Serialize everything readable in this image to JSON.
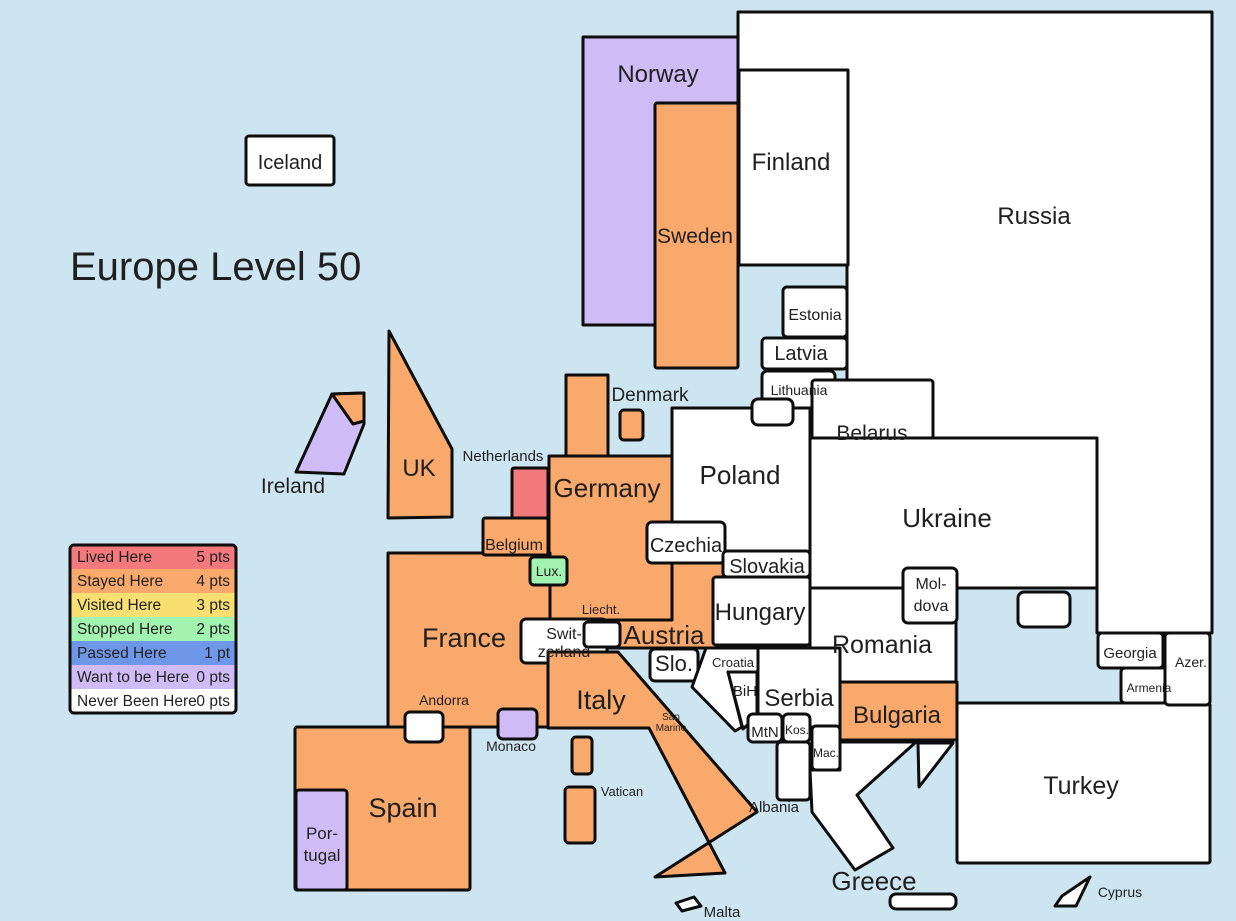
{
  "title": "Europe Level 50",
  "palette": {
    "sea": "#cde5f1",
    "outline": "#0d0d0d",
    "lived": "#f4797d",
    "stayed": "#f9a96b",
    "visited": "#f9df72",
    "stopped": "#a2f2b0",
    "passed": "#6e97e9",
    "want": "#cfbcf7",
    "never": "#ffffff"
  },
  "legend": {
    "rows": [
      {
        "label": "Lived Here",
        "points": "5 pts",
        "color": "#f4797d"
      },
      {
        "label": "Stayed Here",
        "points": "4 pts",
        "color": "#f9a96b"
      },
      {
        "label": "Visited Here",
        "points": "3 pts",
        "color": "#f9df72"
      },
      {
        "label": "Stopped Here",
        "points": "2 pts",
        "color": "#a2f2b0"
      },
      {
        "label": "Passed Here",
        "points": "1 pt",
        "color": "#6e97e9"
      },
      {
        "label": "Want to be Here",
        "points": "0 pts",
        "color": "#cfbcf7"
      },
      {
        "label": "Never Been Here",
        "points": "0 pts",
        "color": "#ffffff"
      }
    ]
  },
  "countries": {
    "iceland": {
      "label": "Iceland",
      "status": "never"
    },
    "norway": {
      "label": "Norway",
      "status": "want"
    },
    "sweden": {
      "label": "Sweden",
      "status": "stayed"
    },
    "finland": {
      "label": "Finland",
      "status": "never"
    },
    "russia": {
      "label": "Russia",
      "status": "never"
    },
    "estonia": {
      "label": "Estonia",
      "status": "never"
    },
    "latvia": {
      "label": "Latvia",
      "status": "never"
    },
    "lithuania": {
      "label": "Lithuania",
      "status": "never"
    },
    "denmark": {
      "label": "Denmark",
      "status": "stayed"
    },
    "uk": {
      "label": "UK",
      "status": "stayed"
    },
    "ireland": {
      "label": "Ireland",
      "status": "want"
    },
    "netherlands": {
      "label": "Netherlands",
      "status": "lived"
    },
    "belgium": {
      "label": "Belgium",
      "status": "stayed"
    },
    "luxembourg": {
      "label": "Lux.",
      "status": "stopped"
    },
    "germany": {
      "label": "Germany",
      "status": "stayed"
    },
    "poland": {
      "label": "Poland",
      "status": "never"
    },
    "belarus": {
      "label": "Belarus",
      "status": "never"
    },
    "ukraine": {
      "label": "Ukraine",
      "status": "never"
    },
    "czechia": {
      "label": "Czechia",
      "status": "never"
    },
    "slovakia": {
      "label": "Slovakia",
      "status": "never"
    },
    "hungary": {
      "label": "Hungary",
      "status": "never"
    },
    "austria": {
      "label": "Austria",
      "status": "stayed"
    },
    "switzerland": {
      "line1": "Swit-",
      "line2": "zerland",
      "status": "never"
    },
    "liechtenstein": {
      "label": "Liecht.",
      "status": "never"
    },
    "france": {
      "label": "France",
      "status": "stayed"
    },
    "andorra": {
      "label": "Andorra",
      "status": "never"
    },
    "monaco": {
      "label": "Monaco",
      "status": "want"
    },
    "spain": {
      "label": "Spain",
      "status": "stayed"
    },
    "portugal": {
      "line1": "Por-",
      "line2": "tugal",
      "status": "want"
    },
    "italy": {
      "label": "Italy",
      "status": "stayed"
    },
    "san_marino": {
      "line1": "San",
      "line2": "Marino",
      "status": "never"
    },
    "vatican": {
      "label": "Vatican",
      "status": "visited"
    },
    "slovenia": {
      "label": "Slo.",
      "status": "never"
    },
    "croatia": {
      "label": "Croatia",
      "status": "never"
    },
    "bih": {
      "label": "BiH",
      "status": "never"
    },
    "serbia": {
      "label": "Serbia",
      "status": "never"
    },
    "montenegro": {
      "label": "MtN",
      "status": "never"
    },
    "kosovo": {
      "label": "Kos.",
      "status": "never"
    },
    "macedonia": {
      "label": "Mac.",
      "status": "never"
    },
    "albania": {
      "label": "Albania",
      "status": "never"
    },
    "romania": {
      "label": "Romania",
      "status": "never"
    },
    "moldova": {
      "line1": "Mol-",
      "line2": "dova",
      "status": "never"
    },
    "bulgaria": {
      "label": "Bulgaria",
      "status": "stayed"
    },
    "greece": {
      "label": "Greece",
      "status": "never"
    },
    "turkey": {
      "label": "Turkey",
      "status": "never"
    },
    "georgia": {
      "label": "Georgia",
      "status": "never"
    },
    "armenia": {
      "label": "Armenia",
      "status": "never"
    },
    "azerbaijan": {
      "label": "Azer.",
      "status": "never"
    },
    "cyprus": {
      "label": "Cyprus",
      "status": "never"
    },
    "malta": {
      "label": "Malta",
      "status": "never"
    }
  }
}
